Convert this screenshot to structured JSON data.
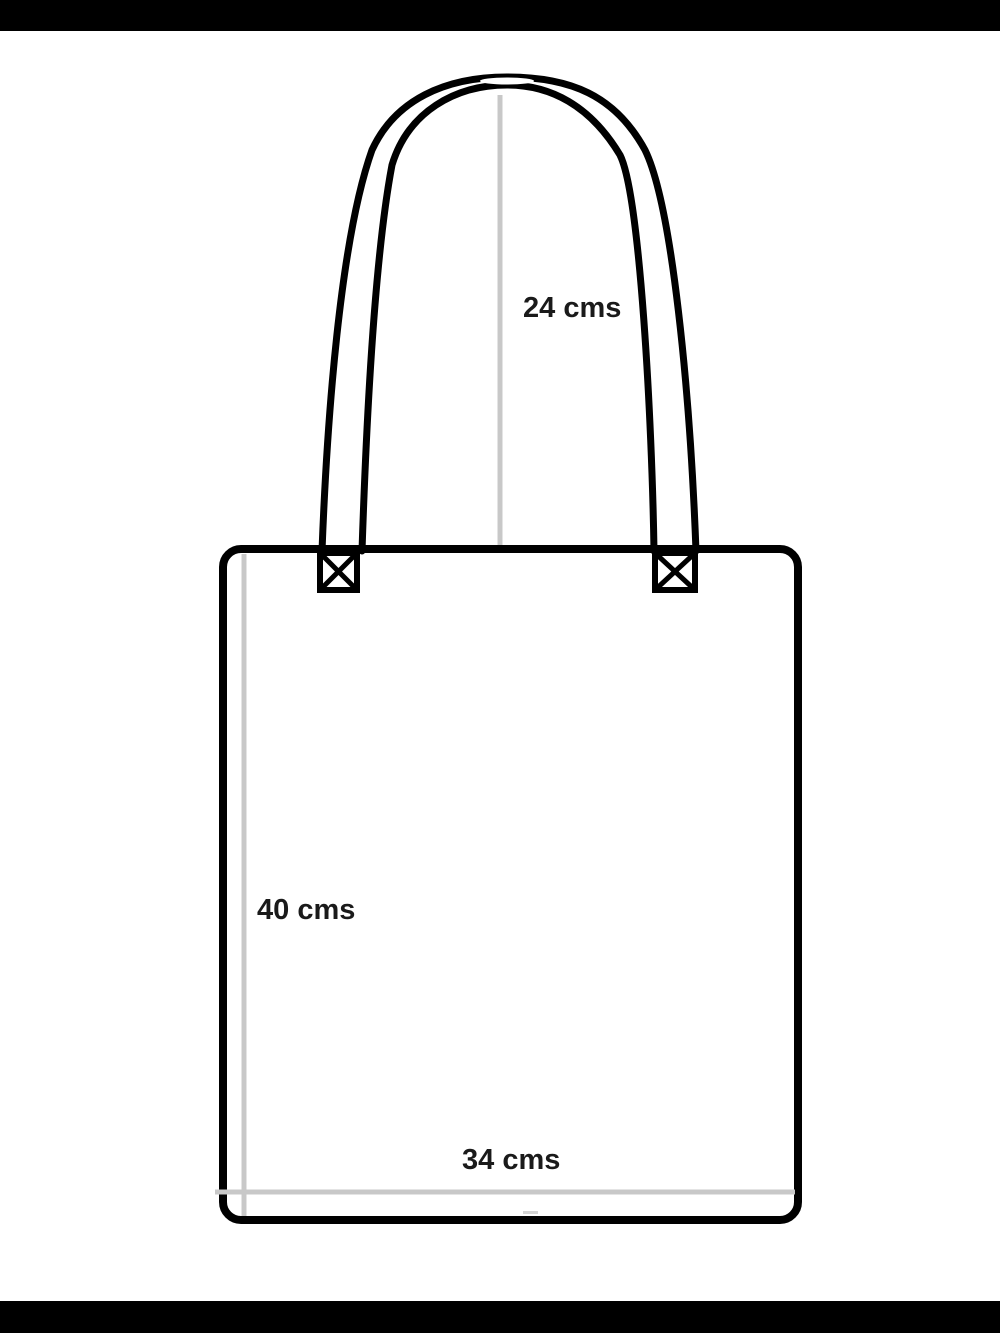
{
  "diagram": {
    "labels": {
      "handle_height": "24 cms",
      "bag_height": "40 cms",
      "bag_width": "34 cms"
    },
    "colors": {
      "line": "#000000",
      "measure": "#c8c8c8",
      "text": "#1a1a1a",
      "bg": "#ffffff",
      "letterbox": "#000000"
    }
  }
}
